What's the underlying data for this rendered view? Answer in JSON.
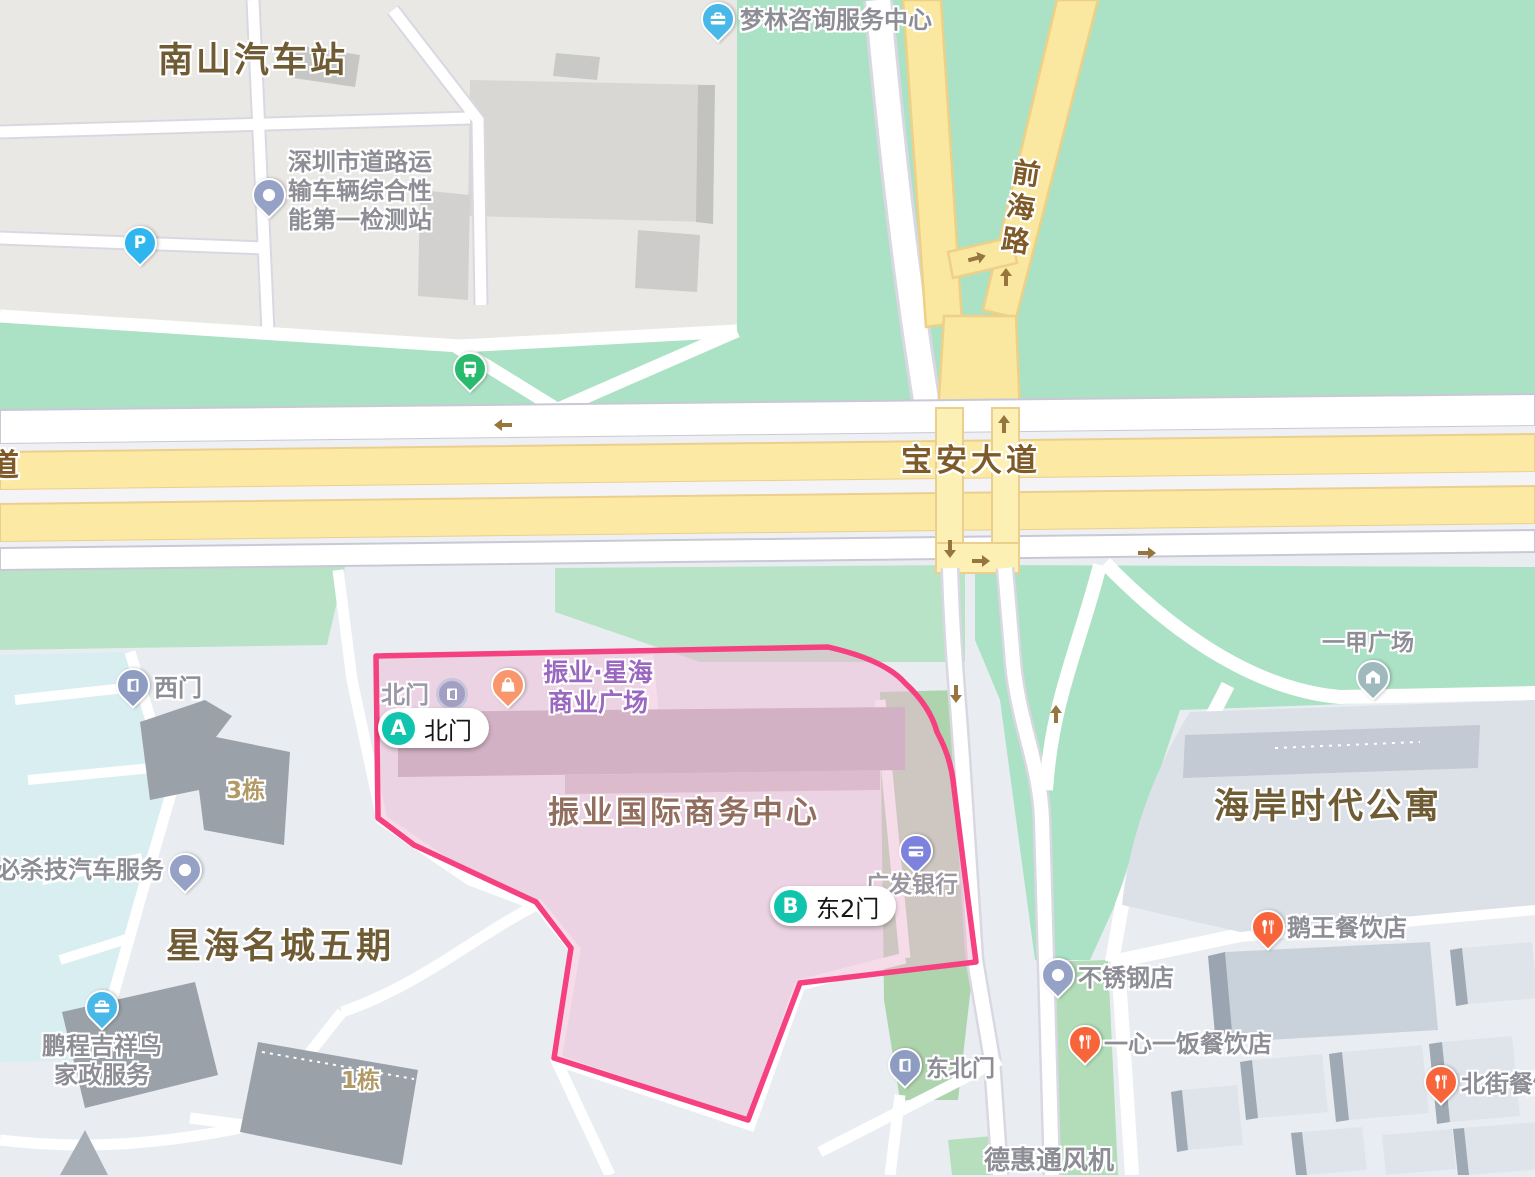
{
  "highlight_area": {
    "name": "振业国际商务中心",
    "border_color": "#f5417f",
    "fill_color": "rgba(238,185,212,0.5)"
  },
  "route_markers": {
    "a": {
      "letter": "A",
      "label": "北门"
    },
    "b": {
      "letter": "B",
      "label": "东2门"
    }
  },
  "road_labels": {
    "baoan": "宝安大道",
    "qianhai": "前海路",
    "partial_left": "道"
  },
  "area_labels": {
    "nanshan": "南山汽车站",
    "xinghai": "星海名城五期",
    "haian": "海岸时代公寓"
  },
  "building_labels": {
    "b3": "3栋",
    "b1": "1栋"
  },
  "gates": {
    "west": {
      "name": "西门",
      "icon": "door-pin"
    },
    "north_poi": {
      "name": "北门",
      "icon": "door-circle-icon"
    },
    "northeast": {
      "name": "东北门",
      "icon": "door-pin"
    }
  },
  "pois": {
    "jiance": {
      "line1": "深圳市道路运",
      "line2": "输车辆综合性",
      "line3": "能第一检测站",
      "icon": "dot-pin"
    },
    "menglin": {
      "name": "梦林咨询服务中心",
      "icon": "briefcase-pin"
    },
    "zhenye_plaza": {
      "line1": "振业·星海",
      "line2": "商业广场",
      "icon": "shopping-bag-pin"
    },
    "gf_bank": {
      "name": "广发银行",
      "icon": "bank-card-pin"
    },
    "bishaji": {
      "name": "必杀技汽车服务",
      "icon": "dot-pin"
    },
    "pengcheng": {
      "line1": "鹏程吉祥鸟",
      "line2": "家政服务",
      "icon": "briefcase-pin"
    },
    "yijia": {
      "name": "一甲广场",
      "icon": "house-pin"
    },
    "ewang": {
      "name": "鹅王餐饮店",
      "icon": "restaurant-pin"
    },
    "buxiugang": {
      "name": "不锈钢店",
      "icon": "dot-pin"
    },
    "yixinyifan": {
      "name": "一心一饭餐饮店",
      "icon": "restaurant-pin"
    },
    "beijie": {
      "name": "北街餐饮店",
      "icon": "restaurant-pin"
    },
    "dehui": {
      "name": "德惠通风机",
      "icon": "none"
    }
  },
  "standalone_icons": {
    "parking": {
      "glyph": "P",
      "icon": "parking-pin",
      "color": "#2fb6ee"
    },
    "bus_stop": {
      "icon": "bus-stop-pin",
      "color": "#2aba6e"
    }
  },
  "colors": {
    "marker_teal": "#10c4ad",
    "highlight_border": "#f5417f",
    "major_road_yellow": "#fbe9a4",
    "green_area": "#abe1c4",
    "poi_text_gray": "#8d8d96",
    "area_text_brown": "#6f5c34",
    "road_text_brown": "#7d5a28",
    "orange_pin": "#f9653a",
    "blue_pin": "#47b8e8",
    "card_pin": "#7d82dc",
    "door_pin": "#8e9cc2"
  }
}
